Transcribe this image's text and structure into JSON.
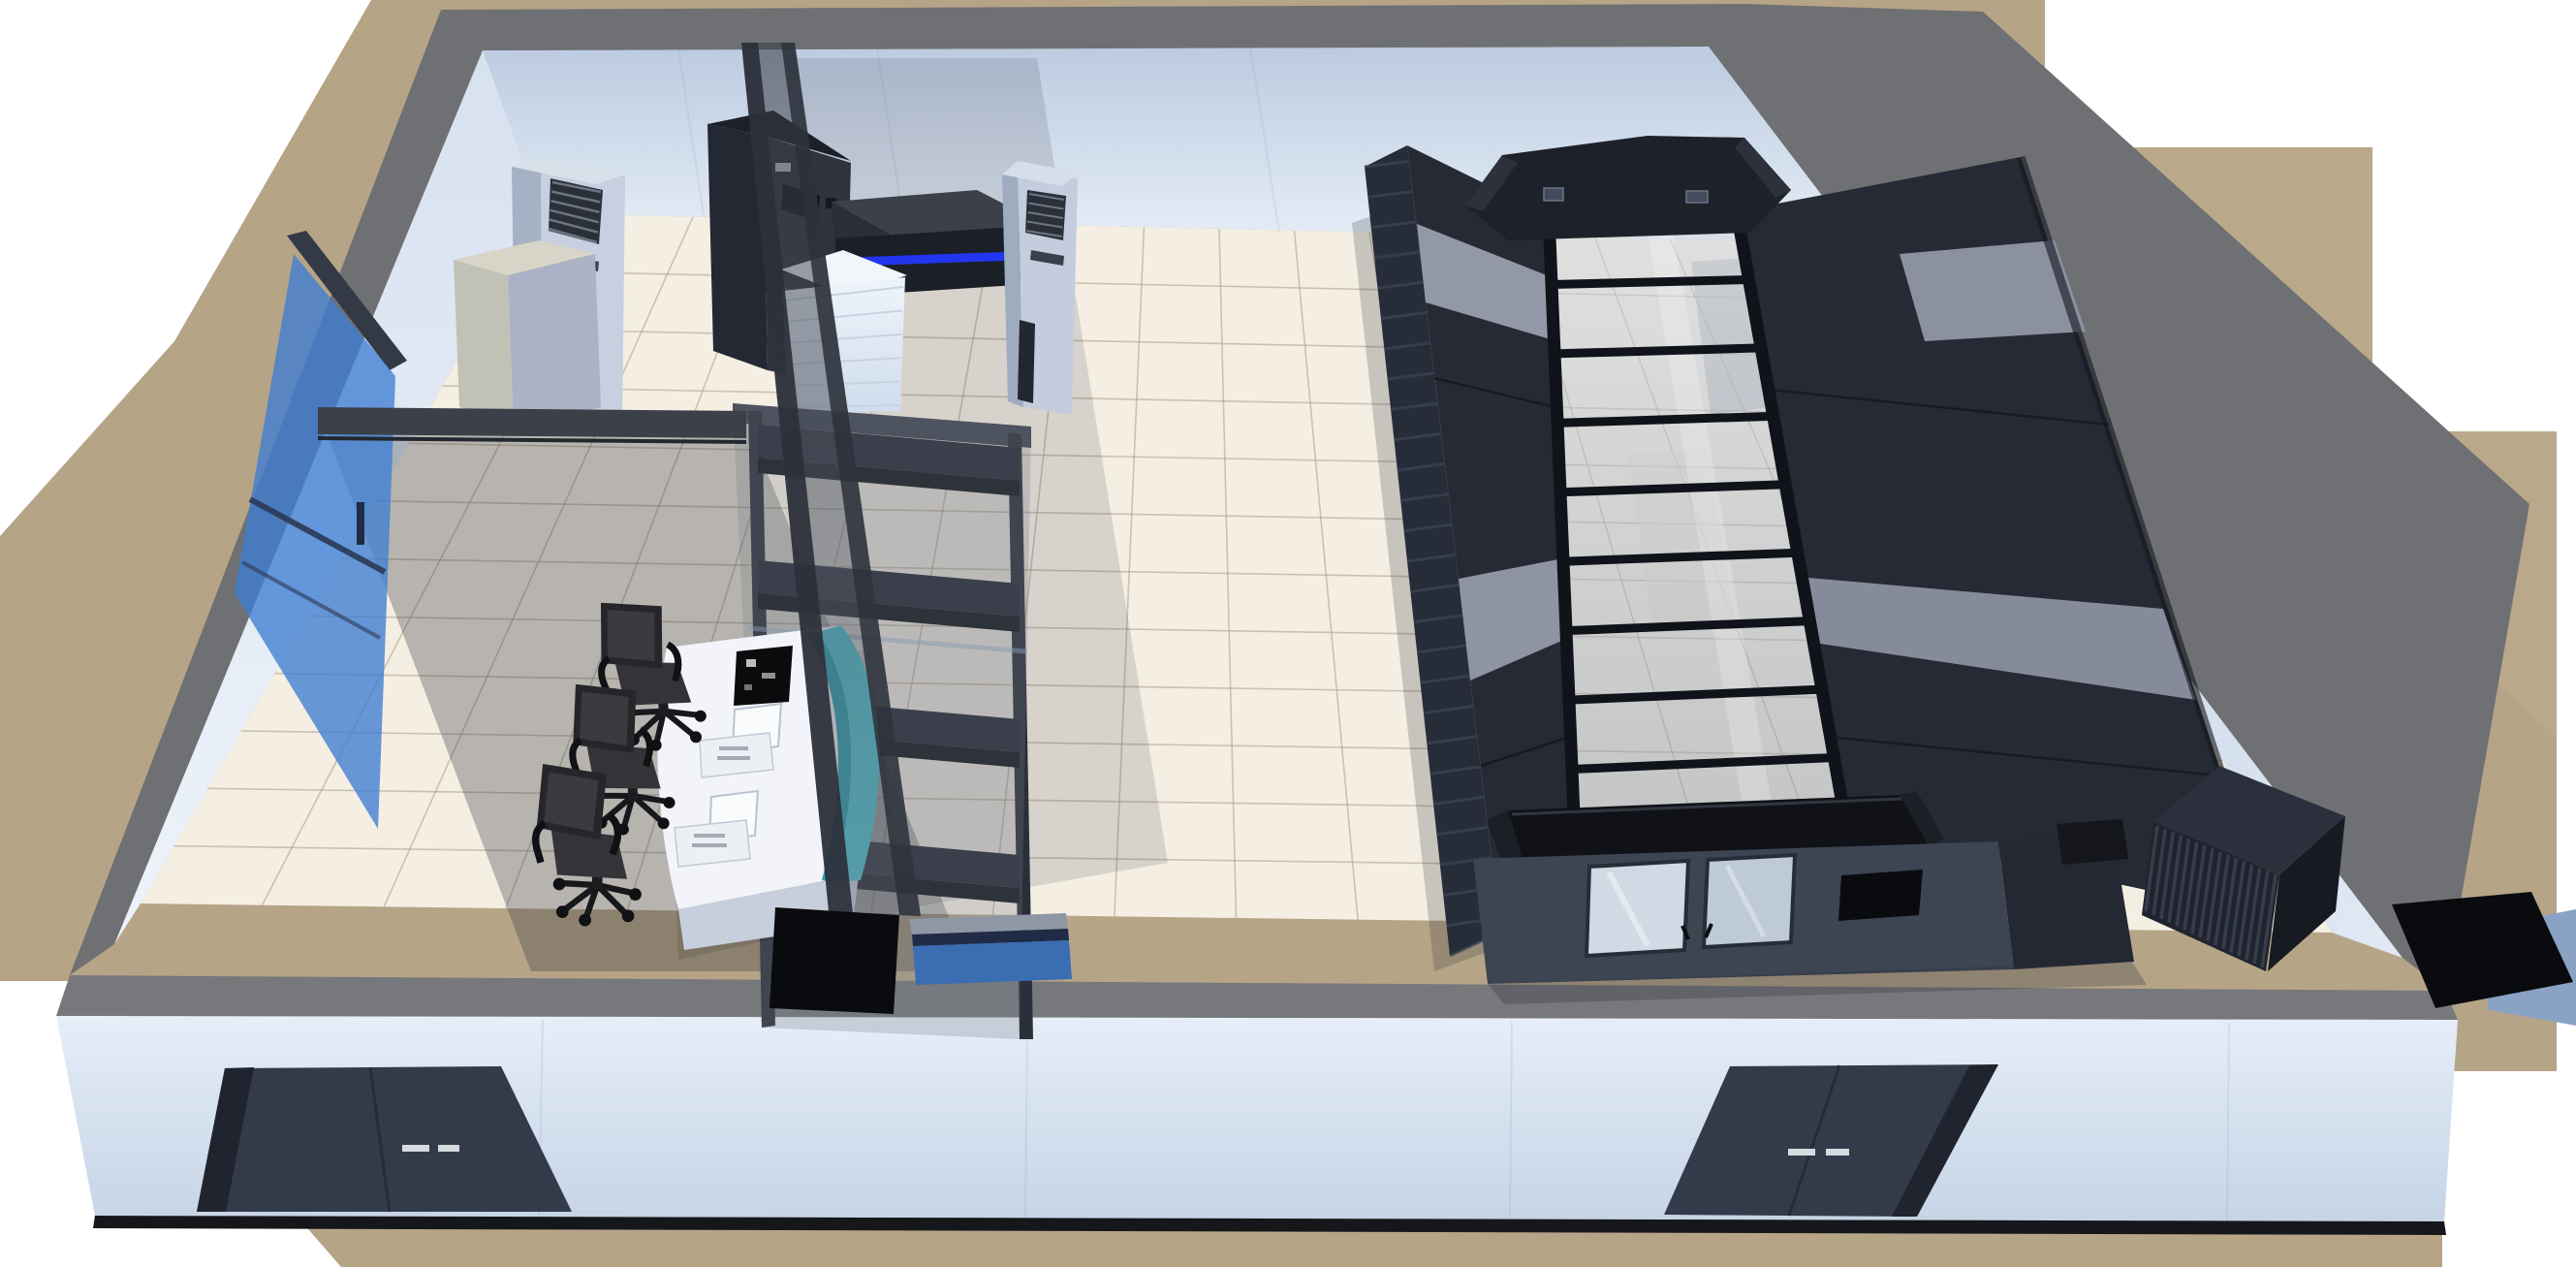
{
  "scene": {
    "kind": "3d-room-render",
    "room_zones": [
      "operator-room",
      "server-room"
    ],
    "counts": {
      "operator_chairs": 3,
      "workstations": 3,
      "front_double_doors": 2,
      "aisle_sliding_doors": 2,
      "server_rack_rows": 2,
      "shelf_levels": 4,
      "precision_ac_units": 2
    }
  },
  "palette": {
    "ground": "#b6a487",
    "groundLight": "#c2b193",
    "wallTop": "#6f7073",
    "wallFrontBand": "#77787b",
    "floor": "#f4eee3",
    "gridLine": "#a99d89",
    "rackDark": "#262a34",
    "rackLight": "#8e94a4",
    "frameBlack": "#10131a",
    "canopy": "#1d212a",
    "endWall": "#3d4552",
    "doorNavy": "#333b4b",
    "handleSilver": "#d5dade",
    "partition": "#30343d",
    "blueGlass": "#3f7ed2",
    "teal": "#4fc3d0",
    "tealDark": "#2e9fae",
    "deskWhite": "#f2f4f9",
    "chairDark": "#26262a",
    "upsFront": "#2e333e",
    "acFront": "#c6d0e0",
    "acSide": "#a6b1c5",
    "beigeTop": "#d8d4c7",
    "beigeFront": "#a9b3c5",
    "batteryWhite": "#e9f0f9",
    "blueCabinet": "#3a6db2",
    "ledBlue": "#2236f0",
    "condenser": "#20242e",
    "blackPanel": "#0a0b0f",
    "steelBlue": "#8aa2c4",
    "redBadge": "#8c1f24",
    "shadow": "#2a2e38"
  },
  "floor_grid": {
    "columns": 18,
    "rows": 12
  },
  "glass_roof": {
    "transverse_bars": 8
  },
  "detail": {
    "left_row_hatch_lines": 26,
    "condenser_fin_lines": 15,
    "grille_lines": 5,
    "battery_lines": 5,
    "ups_vent_lines": 5
  },
  "objects": [
    {
      "name": "ground-plane",
      "interactable": false
    },
    {
      "name": "tiled-floor",
      "interactable": false
    },
    {
      "name": "back-wall",
      "interactable": false
    },
    {
      "name": "left-wall",
      "interactable": false
    },
    {
      "name": "right-wall",
      "interactable": false
    },
    {
      "name": "front-wall",
      "interactable": false
    },
    {
      "name": "front-door-left",
      "interactable": true
    },
    {
      "name": "front-door-right",
      "interactable": true
    },
    {
      "name": "blue-glass-door",
      "interactable": true
    },
    {
      "name": "glass-partition",
      "interactable": false
    },
    {
      "name": "precision-ac-unit-1",
      "interactable": true
    },
    {
      "name": "precision-ac-unit-2",
      "interactable": true
    },
    {
      "name": "beige-cabinet",
      "interactable": true
    },
    {
      "name": "ups-cabinet",
      "interactable": true
    },
    {
      "name": "network-cabinet",
      "interactable": true
    },
    {
      "name": "battery-stack",
      "interactable": true
    },
    {
      "name": "equipment-shelf-rack",
      "interactable": true
    },
    {
      "name": "control-desk",
      "interactable": true
    },
    {
      "name": "operator-chair",
      "interactable": true
    },
    {
      "name": "workstation-monitor",
      "interactable": true
    },
    {
      "name": "server-rack-row-left",
      "interactable": true
    },
    {
      "name": "server-rack-row-right",
      "interactable": true
    },
    {
      "name": "cold-aisle-glass-roof",
      "interactable": true
    },
    {
      "name": "aisle-end-canopy",
      "interactable": false
    },
    {
      "name": "aisle-sliding-door",
      "interactable": true
    },
    {
      "name": "aisle-end-display",
      "interactable": true
    },
    {
      "name": "condenser-unit",
      "interactable": true
    },
    {
      "name": "wall-mounted-panel",
      "interactable": true
    },
    {
      "name": "blue-low-cabinet",
      "interactable": true
    }
  ]
}
